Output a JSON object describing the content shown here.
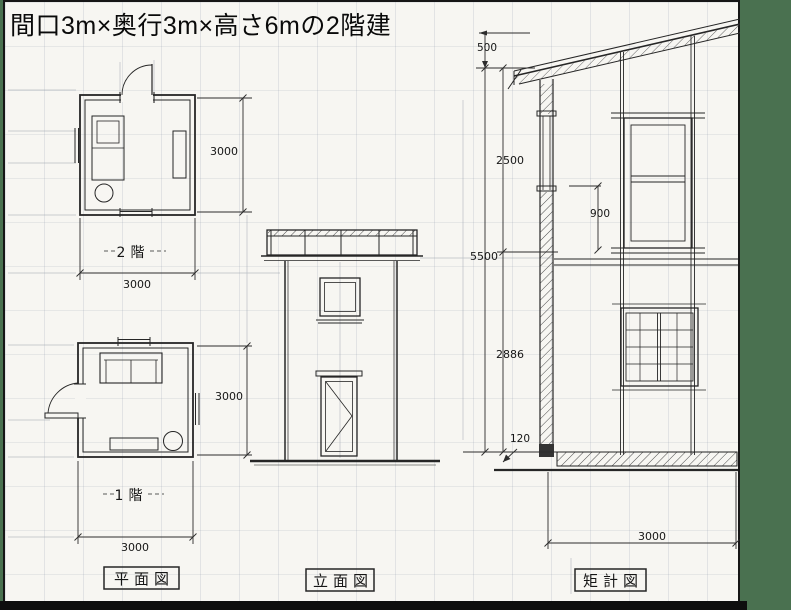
{
  "title": "間口3m×奥行3m×高さ6mの2階建",
  "colors": {
    "backdrop_green": "#4a7150",
    "paper": "#f7f6f2",
    "ink": "#262626"
  },
  "floor_plans": {
    "second": {
      "label": "2階",
      "depth_mm": "3000",
      "width_mm": "3000"
    },
    "first": {
      "label": "1階",
      "depth_mm": "3000",
      "width_mm": "3000"
    }
  },
  "elevation": {},
  "section_dims": {
    "roof_rise": "500",
    "upper_height": "2500",
    "total_height": "5500",
    "window_height": "900",
    "lower_height": "2886",
    "slab_thickness": "120",
    "width": "3000"
  },
  "captions": {
    "floor_plan": "平面図",
    "elevation": "立面図",
    "section": "矩計図"
  }
}
